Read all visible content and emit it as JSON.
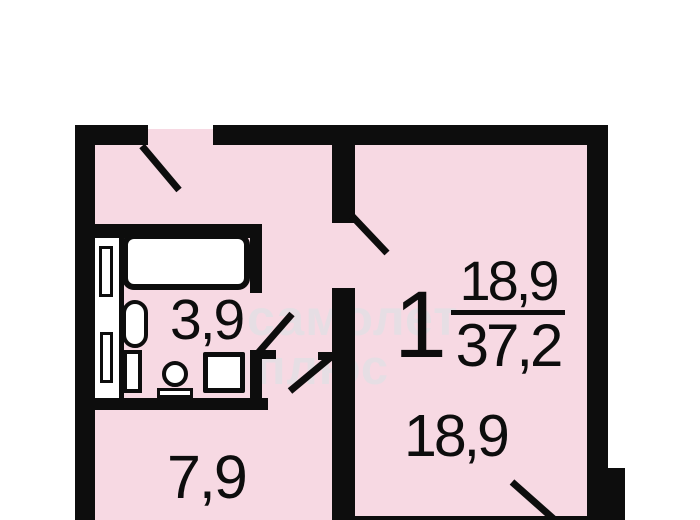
{
  "floor_plan": {
    "apartment_label": "1",
    "total_area": {
      "numerator": "18,9",
      "denominator": "37,2"
    },
    "rooms": [
      {
        "name": "bathroom",
        "area_label": "3,9"
      },
      {
        "name": "kitchen",
        "area_label": "7,9"
      },
      {
        "name": "living-room",
        "area_label": "18,9"
      }
    ],
    "watermark": {
      "line1": "самолет",
      "line2": "плюс"
    },
    "fixtures": [
      "bathtub",
      "toilet",
      "sink",
      "washing-machine",
      "duct-shaft"
    ],
    "colors": {
      "room_fill": "#f7d9e3",
      "wall": "#0d0d0d",
      "fixture_fill": "#ffffff",
      "background": "#ffffff",
      "watermark": "#e6dee4"
    }
  }
}
